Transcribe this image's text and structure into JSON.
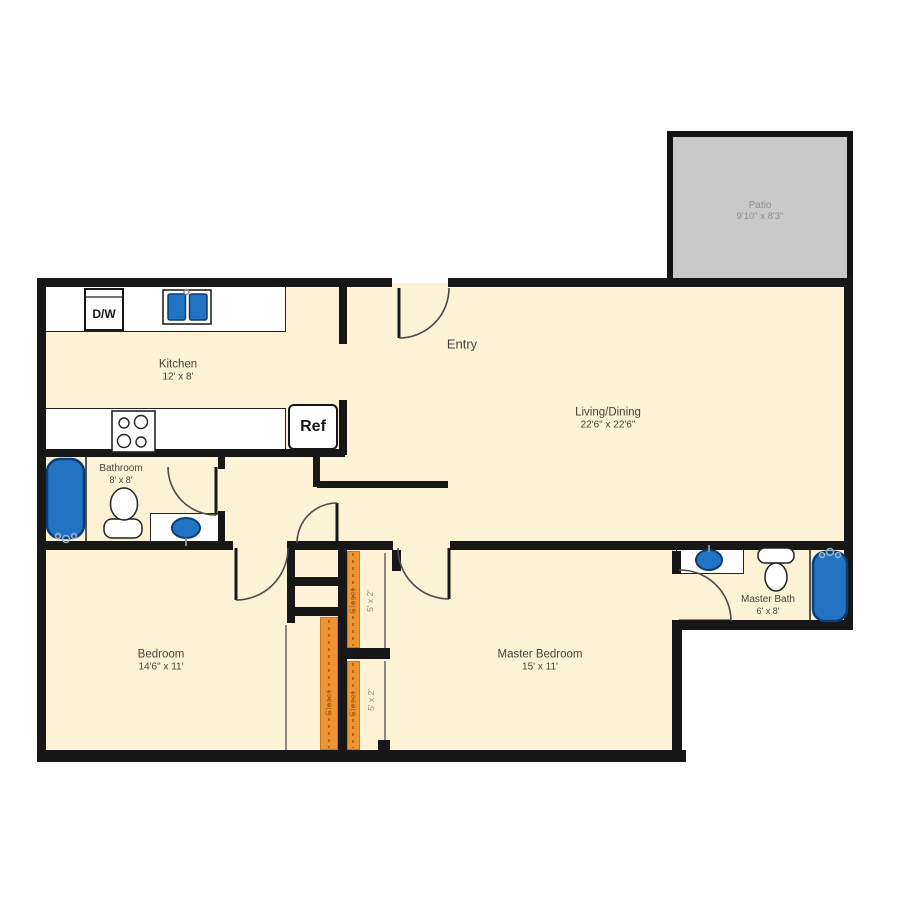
{
  "plan": {
    "title": "2 Bed 1.5 Bath Floor Plan",
    "patio": {
      "name": "Patio",
      "dims": "9'10\" x 8'3\""
    },
    "entry_label": "Entry",
    "rooms": [
      {
        "id": "kitchen",
        "name": "Kitchen",
        "dims": "12' x 8'"
      },
      {
        "id": "living_dining",
        "name": "Living/Dining",
        "dims": "22'6\" x 22'6\""
      },
      {
        "id": "bathroom",
        "name": "Bathroom",
        "dims": "8' x 8'"
      },
      {
        "id": "bedroom",
        "name": "Bedroom",
        "dims": "14'6\" x 11'"
      },
      {
        "id": "master_bedroom",
        "name": "Master Bedroom",
        "dims": "15' x 11'"
      },
      {
        "id": "master_bath",
        "name": "Master Bath",
        "dims": "6' x 8'"
      }
    ],
    "appliances": {
      "dishwasher": "D/W",
      "refrigerator": "Ref"
    },
    "closet": {
      "label": "Closet",
      "dims": "5' x 2'"
    },
    "colors": {
      "floor": "#FCF3D6",
      "wall": "#171717",
      "patio_fill": "#C9C9C9",
      "fixture_blue": "#2273C2",
      "fixture_blue_border": "#0B3E74",
      "closet_orange": "#EE9434",
      "closet_rod_dash": "#B96A0A",
      "label_text": "#45423A",
      "patio_text": "#8F8F8F"
    }
  }
}
